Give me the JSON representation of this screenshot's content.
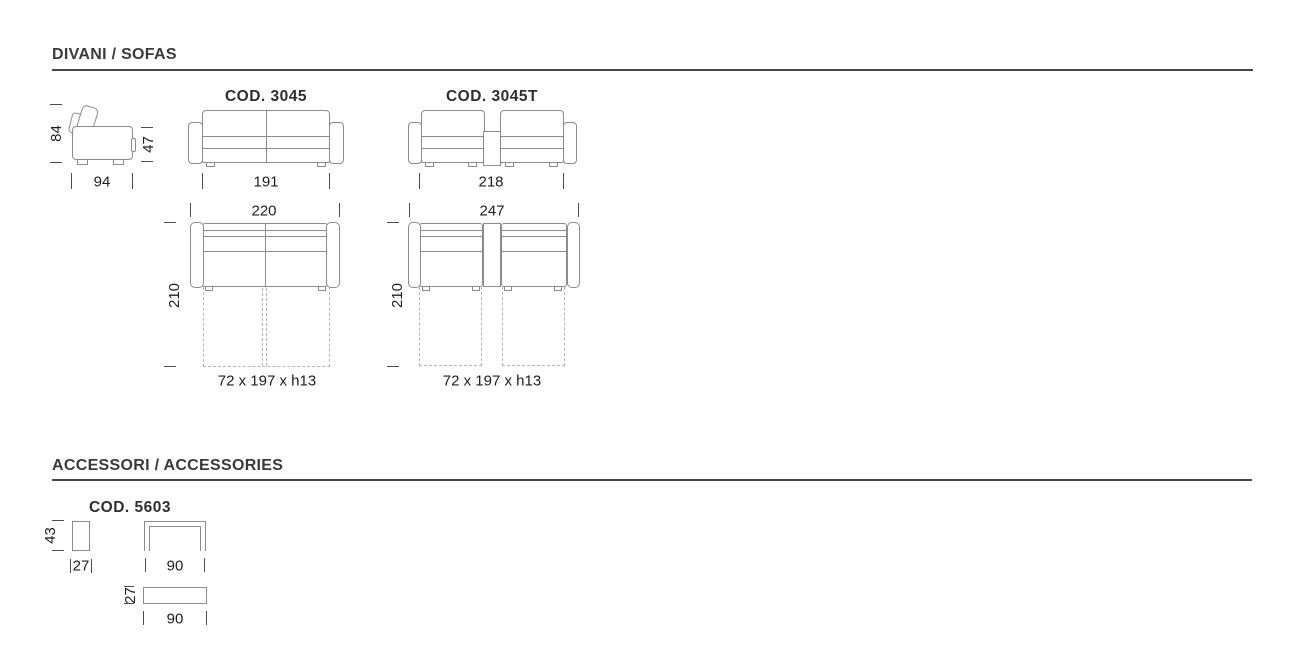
{
  "colors": {
    "line": "#8c8c8c",
    "dash": "#b3b3b3",
    "text": "#1e1e1e",
    "heading": "#3a3a3a",
    "rule": "#474747",
    "tick": "#4d4d4d",
    "background": "#ffffff"
  },
  "page": {
    "sofas": {
      "title": "DIVANI / SOFAS",
      "side": {
        "height": "84",
        "seat_height": "47",
        "depth": "94"
      },
      "model_a": {
        "code": "COD. 3045",
        "front_width": "191",
        "top_width": "220",
        "open_depth": "210",
        "bed": "72 x 197 x h13"
      },
      "model_b": {
        "code": "COD. 3045T",
        "front_width": "218",
        "top_width": "247",
        "open_depth": "210",
        "bed": "72 x 197 x h13"
      }
    },
    "accessories": {
      "title": "ACCESSORI / ACCESSORIES",
      "model": {
        "code": "COD. 5603",
        "side_height": "43",
        "side_width": "27",
        "front_width": "90",
        "top_depth": "27",
        "top_width": "90"
      }
    }
  }
}
